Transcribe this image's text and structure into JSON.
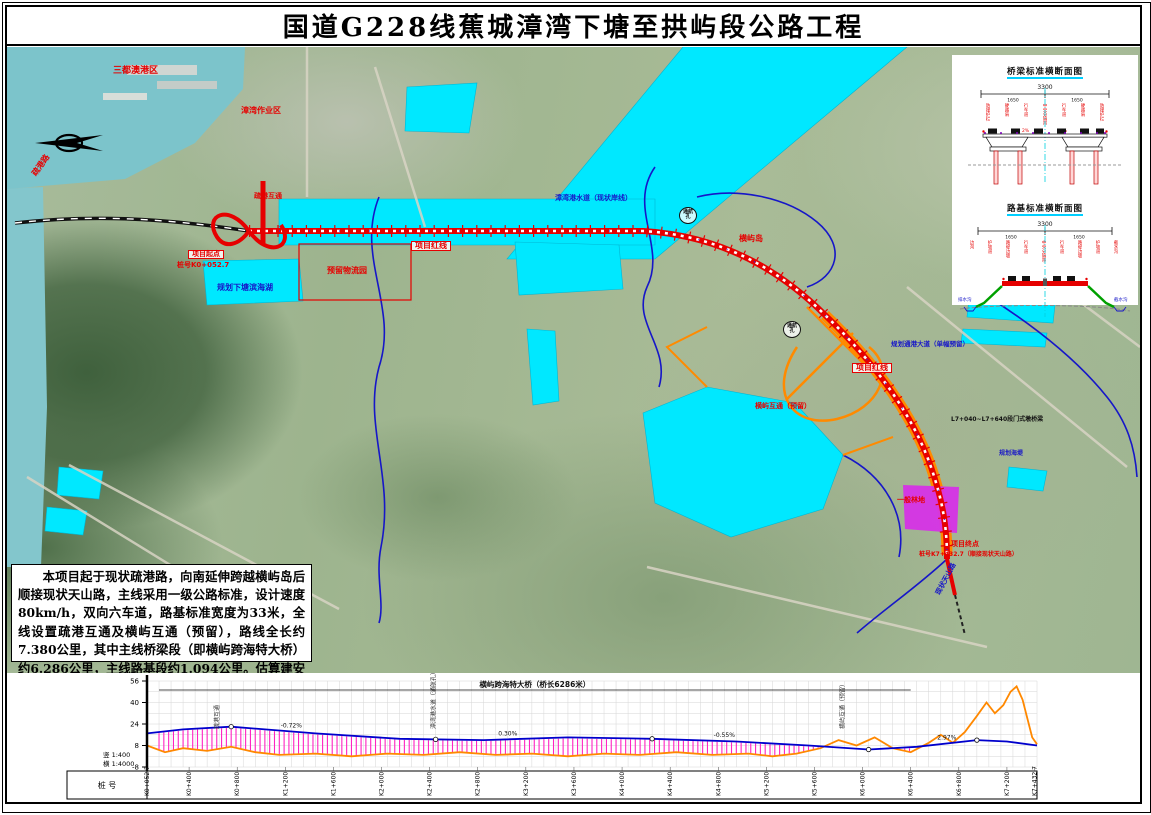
{
  "page": {
    "title": "国道G228线蕉城漳湾下塘至拱屿段公路工程"
  },
  "description_box": {
    "text": "本项目起于现状疏港路，向南延伸跨越横屿岛后顺接现状天山路，主线采用一级公路标准，设计速度80km/h，双向六车道，路基标准宽度为33米，全线设置疏港互通及横屿互通（预留），路线全长约7.380公里，其中主线桥梁段（即横屿跨海特大桥）约6.286公里，主线路基段约1.094公里。估算建安费用约16.984亿元，总投资约20.931亿元。"
  },
  "sections_panel": {
    "bridge_section": {
      "title": "桥梁标准横断面图",
      "dim_total": "3300",
      "dim_halves": [
        "1650",
        "1650"
      ],
      "slope_label": "2%",
      "column_labels": [
        "防撞护栏",
        "硬路肩",
        "行车道",
        "中央分隔带",
        "行车道",
        "硬路肩",
        "防撞护栏"
      ]
    },
    "roadbed_section": {
      "title": "路基标准横断面图",
      "dim_total": "3300",
      "dim_halves": [
        "1650",
        "1650"
      ],
      "left_side_label": "排水沟",
      "right_side_label": "截水沟",
      "column_labels": [
        "边沟",
        "护坡道",
        "路堤边坡",
        "行车道",
        "中央分隔带",
        "行车道",
        "路堤边坡",
        "护坡道",
        "截水沟"
      ]
    }
  },
  "map": {
    "labels": [
      {
        "text": "三都澳港区",
        "x": 106,
        "y": 20,
        "color": "#e60000",
        "size": 9
      },
      {
        "text": "漳湾作业区",
        "x": 234,
        "y": 60,
        "color": "#e60000",
        "size": 8
      },
      {
        "text": "疏港路",
        "x": 24,
        "y": 126,
        "color": "#e60000",
        "size": 8,
        "rot": -55
      },
      {
        "text": "疏港互通",
        "x": 247,
        "y": 146,
        "color": "#e60000",
        "size": 7
      },
      {
        "text": "项目起点",
        "x": 181,
        "y": 203,
        "color": "#e60000",
        "size": 7,
        "boxed": true
      },
      {
        "text": "桩号K0+052.7",
        "x": 170,
        "y": 215,
        "color": "#e60000",
        "size": 7
      },
      {
        "text": "规划下塘滨海湖",
        "x": 210,
        "y": 237,
        "color": "#1616c8",
        "size": 8
      },
      {
        "text": "预留物流园",
        "x": 320,
        "y": 220,
        "color": "#e60000",
        "size": 8
      },
      {
        "text": "项目红线",
        "x": 404,
        "y": 194,
        "color": "#e60000",
        "size": 8,
        "boxed": true
      },
      {
        "text": "漳湾港水道（现状岸线）",
        "x": 548,
        "y": 148,
        "color": "#1616c8",
        "size": 7
      },
      {
        "text": "通航孔",
        "x": 672,
        "y": 160,
        "color": "#111111",
        "size": 5,
        "circled": true
      },
      {
        "text": "通航孔",
        "x": 776,
        "y": 274,
        "color": "#111111",
        "size": 5,
        "circled": true
      },
      {
        "text": "横屿岛",
        "x": 732,
        "y": 188,
        "color": "#e60000",
        "size": 8
      },
      {
        "text": "规划通港大道（单幅预留）",
        "x": 884,
        "y": 294,
        "color": "#1616c8",
        "size": 6.5
      },
      {
        "text": "项目红线",
        "x": 845,
        "y": 316,
        "color": "#e60000",
        "size": 8,
        "boxed": true
      },
      {
        "text": "横屿互通（预留）",
        "x": 748,
        "y": 356,
        "color": "#e60000",
        "size": 7
      },
      {
        "text": "L7+040~L7+640段门式墩桥梁",
        "x": 944,
        "y": 370,
        "color": "#111111",
        "size": 6
      },
      {
        "text": "规划海堤",
        "x": 992,
        "y": 404,
        "color": "#1616c8",
        "size": 6
      },
      {
        "text": "一般林地",
        "x": 890,
        "y": 450,
        "color": "#e60000",
        "size": 7
      },
      {
        "text": "项目终点",
        "x": 944,
        "y": 494,
        "color": "#e60000",
        "size": 7
      },
      {
        "text": "桩号K7+432.7（顺接现状天山路）",
        "x": 912,
        "y": 505,
        "color": "#e60000",
        "size": 6
      },
      {
        "text": "现状天山路",
        "x": 928,
        "y": 546,
        "color": "#1616c8",
        "size": 7,
        "rot": -62
      }
    ]
  },
  "profile": {
    "scale_v": "竖 1:400",
    "scale_h": "横 1:4000",
    "row_header": "桩 号",
    "elev_ticks": [
      56,
      40,
      24,
      8,
      -8
    ],
    "station_max": 7400,
    "bridge_annotation": "横屿跨海特大桥（桥长6286米）",
    "annotations": [
      {
        "s": 600,
        "text": "疏港互通"
      },
      {
        "s": 2400,
        "text": "漳湾港水道（通航孔）"
      },
      {
        "s": 5800,
        "text": "横屿互通（预留）"
      }
    ],
    "grades": [
      {
        "s": 1200,
        "text": "-0.72%"
      },
      {
        "s": 3000,
        "text": "0.30%"
      },
      {
        "s": 4800,
        "text": "-0.55%"
      },
      {
        "s": 6650,
        "text": "2.97%"
      }
    ],
    "markers": [
      700,
      2400,
      4200,
      6000,
      6900
    ],
    "stakes": [
      {
        "s": 0,
        "label": "K0+052.7"
      },
      {
        "s": 350,
        "label": "K0+400"
      },
      {
        "s": 750,
        "label": "K0+800"
      },
      {
        "s": 1150,
        "label": "K1+200"
      },
      {
        "s": 1550,
        "label": "K1+600"
      },
      {
        "s": 1950,
        "label": "K2+000"
      },
      {
        "s": 2350,
        "label": "K2+400"
      },
      {
        "s": 2750,
        "label": "K2+800"
      },
      {
        "s": 3150,
        "label": "K3+200"
      },
      {
        "s": 3550,
        "label": "K3+600"
      },
      {
        "s": 3950,
        "label": "K4+000"
      },
      {
        "s": 4350,
        "label": "K4+400"
      },
      {
        "s": 4750,
        "label": "K4+800"
      },
      {
        "s": 5150,
        "label": "K5+200"
      },
      {
        "s": 5550,
        "label": "K5+600"
      },
      {
        "s": 5950,
        "label": "K6+000"
      },
      {
        "s": 6350,
        "label": "K6+400"
      },
      {
        "s": 6750,
        "label": "K6+800"
      },
      {
        "s": 7150,
        "label": "K7+200"
      },
      {
        "s": 7380,
        "label": "K7+432.7"
      }
    ],
    "design_line": [
      [
        0,
        17
      ],
      [
        300,
        20
      ],
      [
        700,
        22
      ],
      [
        1400,
        17
      ],
      [
        2100,
        13
      ],
      [
        2800,
        12
      ],
      [
        3500,
        14
      ],
      [
        4200,
        13
      ],
      [
        4900,
        11
      ],
      [
        5500,
        8
      ],
      [
        6000,
        5
      ],
      [
        6400,
        7
      ],
      [
        6900,
        12
      ],
      [
        7150,
        11
      ],
      [
        7400,
        8
      ]
    ],
    "ground_line": [
      [
        0,
        8
      ],
      [
        150,
        3
      ],
      [
        300,
        6
      ],
      [
        500,
        4
      ],
      [
        700,
        7
      ],
      [
        900,
        3
      ],
      [
        1100,
        1
      ],
      [
        1400,
        2
      ],
      [
        1700,
        0
      ],
      [
        2000,
        2
      ],
      [
        2300,
        1
      ],
      [
        2600,
        3
      ],
      [
        2900,
        1
      ],
      [
        3200,
        2
      ],
      [
        3500,
        0
      ],
      [
        3800,
        2
      ],
      [
        4100,
        1
      ],
      [
        4400,
        3
      ],
      [
        4700,
        1
      ],
      [
        5000,
        2
      ],
      [
        5200,
        0
      ],
      [
        5400,
        2
      ],
      [
        5600,
        6
      ],
      [
        5750,
        12
      ],
      [
        5900,
        8
      ],
      [
        6050,
        14
      ],
      [
        6200,
        6
      ],
      [
        6350,
        3
      ],
      [
        6500,
        10
      ],
      [
        6600,
        16
      ],
      [
        6700,
        10
      ],
      [
        6800,
        18
      ],
      [
        6900,
        30
      ],
      [
        6980,
        40
      ],
      [
        7050,
        32
      ],
      [
        7120,
        38
      ],
      [
        7180,
        48
      ],
      [
        7230,
        52
      ],
      [
        7280,
        42
      ],
      [
        7320,
        28
      ],
      [
        7360,
        14
      ],
      [
        7400,
        9
      ]
    ],
    "bridge_range": [
      100,
      6350
    ],
    "colors": {
      "design": "#0000cc",
      "ground": "#ff8800",
      "hatch": "#ff22c2"
    }
  },
  "chart_data": {
    "type": "line",
    "title": "路线纵断面图",
    "xlabel": "桩号",
    "ylabel": "高程(m)",
    "ylim": [
      -8,
      56
    ],
    "series": [
      {
        "name": "设计线",
        "values": [
          [
            0,
            17
          ],
          [
            300,
            20
          ],
          [
            700,
            22
          ],
          [
            1400,
            17
          ],
          [
            2100,
            13
          ],
          [
            2800,
            12
          ],
          [
            3500,
            14
          ],
          [
            4200,
            13
          ],
          [
            4900,
            11
          ],
          [
            5500,
            8
          ],
          [
            6000,
            5
          ],
          [
            6400,
            7
          ],
          [
            6900,
            12
          ],
          [
            7150,
            11
          ],
          [
            7400,
            8
          ]
        ]
      },
      {
        "name": "地面线",
        "values": [
          [
            0,
            8
          ],
          [
            300,
            6
          ],
          [
            700,
            7
          ],
          [
            1400,
            2
          ],
          [
            2100,
            1
          ],
          [
            2800,
            1
          ],
          [
            3500,
            0
          ],
          [
            4200,
            1
          ],
          [
            4900,
            0
          ],
          [
            5600,
            6
          ],
          [
            5900,
            8
          ],
          [
            6200,
            6
          ],
          [
            6600,
            16
          ],
          [
            6900,
            30
          ],
          [
            7230,
            52
          ],
          [
            7400,
            9
          ]
        ]
      }
    ]
  }
}
